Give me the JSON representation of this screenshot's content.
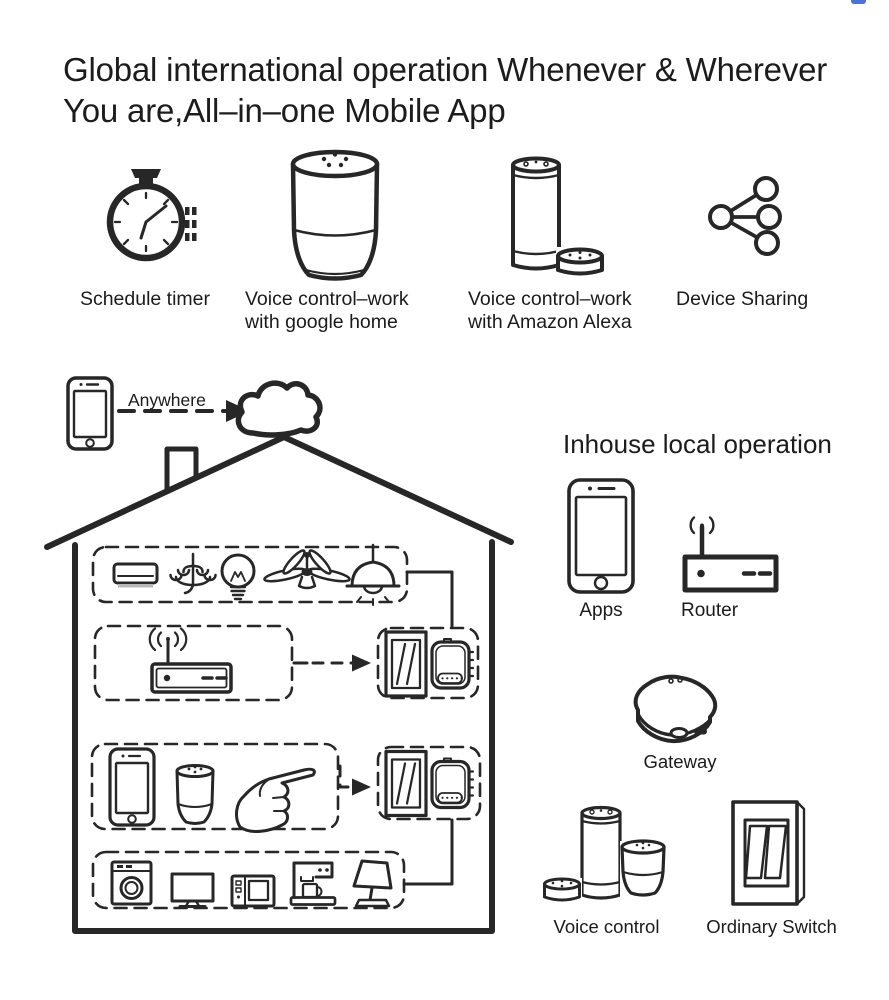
{
  "header": {
    "title_line1": "Global international operation Whenever & Wherever",
    "title_line2": "You are,All–in–one Mobile App"
  },
  "features": [
    {
      "label_line1": "Schedule timer",
      "label_line2": ""
    },
    {
      "label_line1": "Voice control–work",
      "label_line2": "with google home"
    },
    {
      "label_line1": "Voice control–work",
      "label_line2": "with Amazon Alexa"
    },
    {
      "label_line1": "Device Sharing",
      "label_line2": ""
    }
  ],
  "cloud_diagram": {
    "phone_app_label": "APP",
    "anywhere_label": "Anywhere"
  },
  "house": {
    "indoor_phone_app_label": "APP"
  },
  "local_operation": {
    "heading": "Inhouse local operation",
    "phone_app_label": "APP",
    "apps_label": "Apps",
    "router_label": "Router",
    "gateway_label": "Gateway",
    "voice_control_label": "Voice control",
    "ordinary_switch_label": "Ordinary Switch"
  },
  "colors": {
    "line": "#272727",
    "accent_blue": "#4a72d8"
  }
}
